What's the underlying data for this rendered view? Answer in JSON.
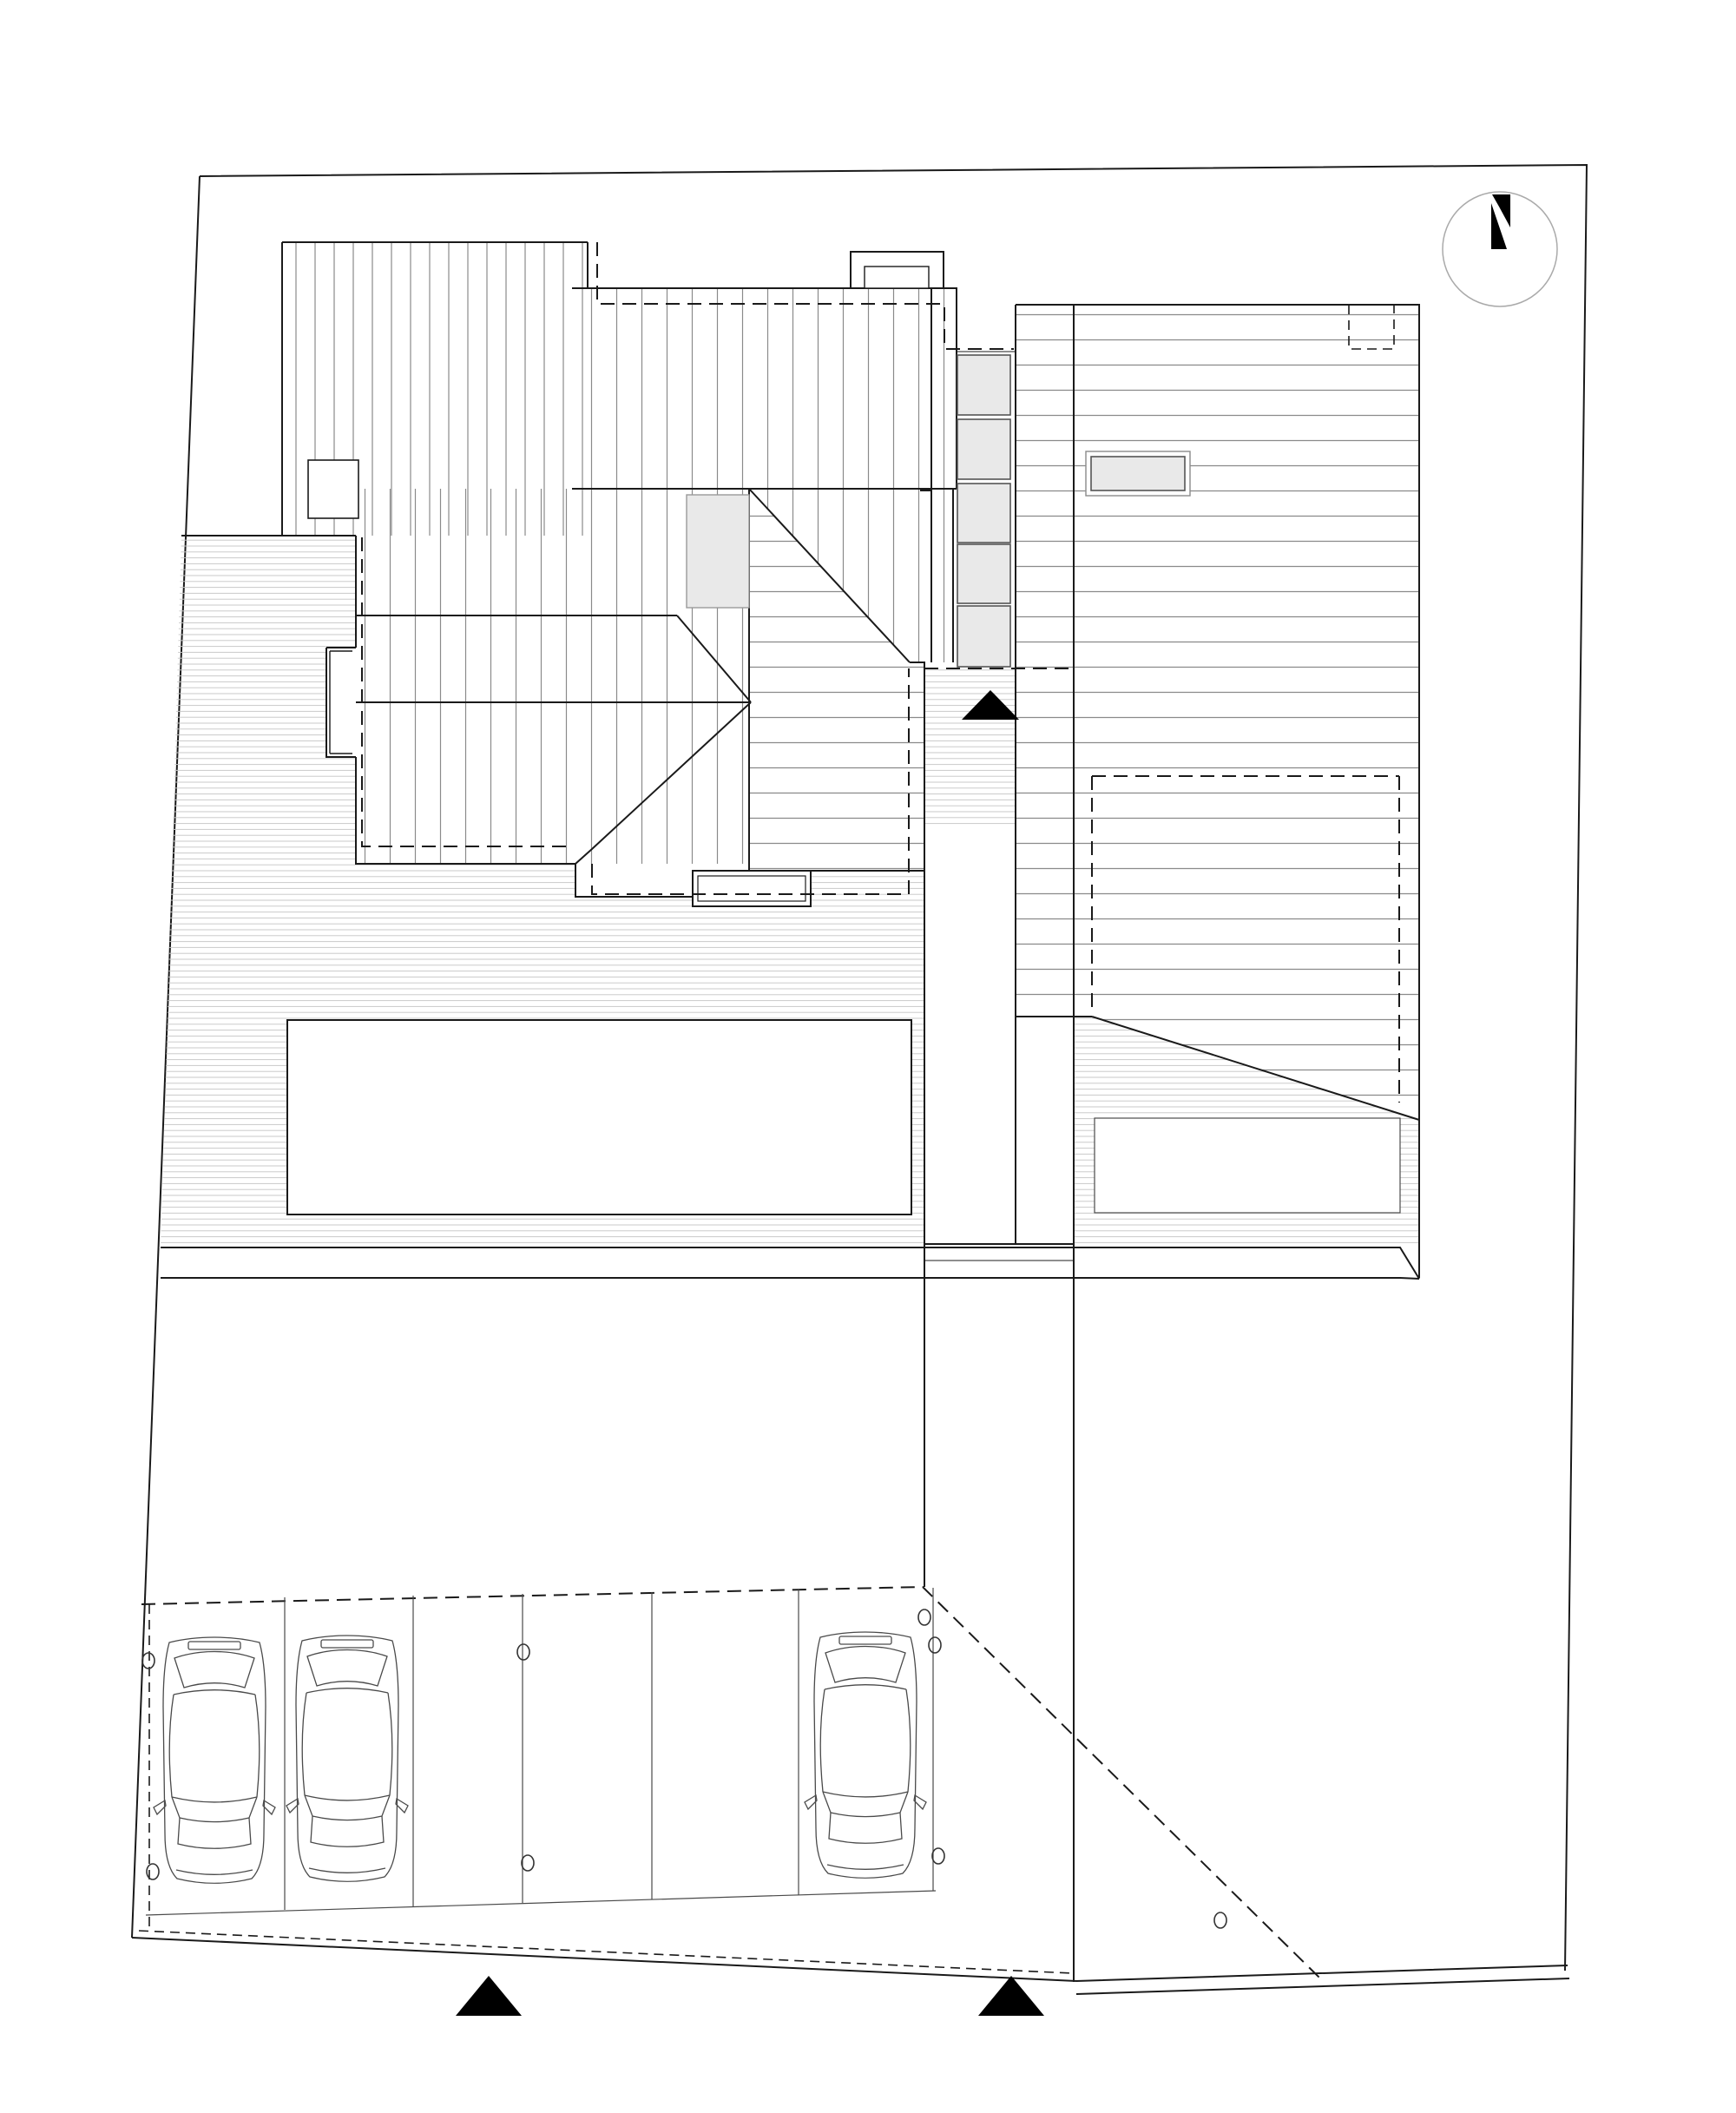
{
  "meta": {
    "document_type": "architectural-site-plan",
    "view": "roof-plan-with-site",
    "visible_text": [],
    "paper_color": "#ffffff"
  },
  "colors": {
    "paper": "#ffffff",
    "line_strong": "#1a1a1a",
    "line_medium": "#4a4a4a",
    "roof_hatch": "#8a8a8a",
    "deck_hatch": "#c9c9c9",
    "skylight_fill": "#e9e9e9",
    "marker_fill": "#000000",
    "compass_ring": "#aaaaaa"
  },
  "site": {
    "boundary_shape": "irregular quadrilateral, slightly tapering",
    "north_arrow": {
      "style": "black stylized N inside thin circle",
      "position": "top-right"
    }
  },
  "buildings": {
    "left_house": {
      "roof_hatch_direction": "vertical",
      "skylights": 1,
      "chimneys": 2,
      "bay_projection_west": 1,
      "hip_ridge_lines": true,
      "dashed_overhang_outline": true
    },
    "right_house": {
      "roof_hatch_direction": "horizontal",
      "roof_vent": 1,
      "dashed_roof_notch_top_right": 1,
      "dashed_lower_floor_outline": true,
      "diagonal_roof_cut": true,
      "lower_terrace_rectangle": 1
    }
  },
  "landscape": {
    "deck_terrace": "fine horizontal hatch around buildings",
    "pool_or_lawn_rectangles": 2,
    "entry_stair_blocks": 5
  },
  "parking": {
    "stalls": 6,
    "cars": 3,
    "bollard_circles": 8,
    "entry_marker_triangles": 3,
    "dashed_apron_line": true
  }
}
